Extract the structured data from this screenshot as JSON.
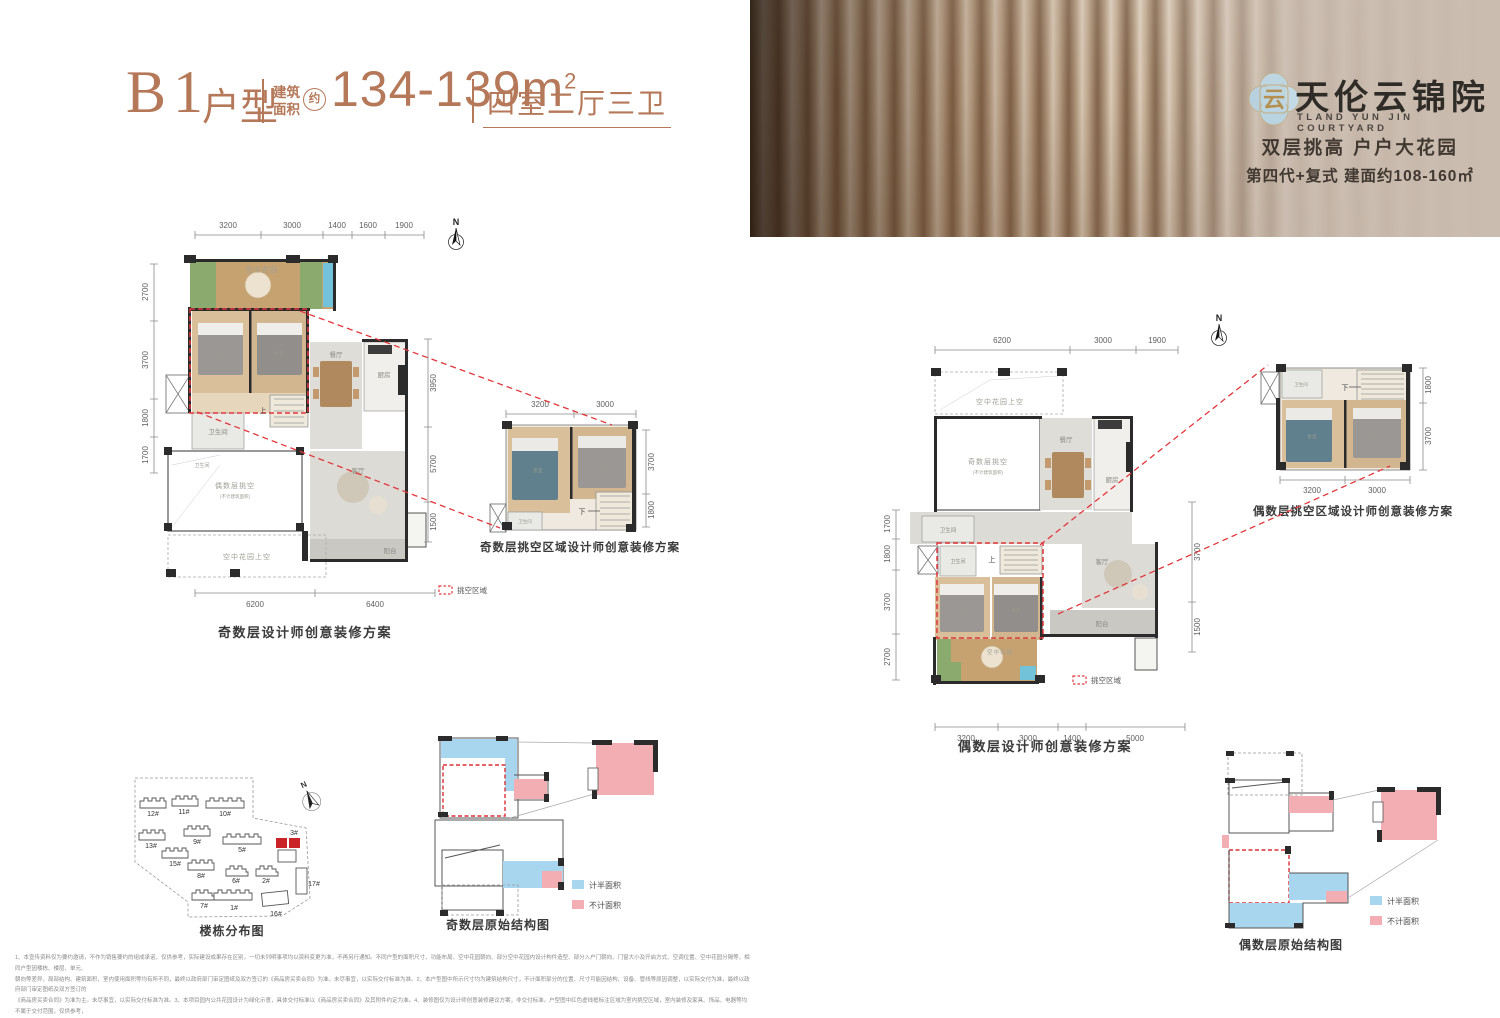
{
  "title": {
    "code": "B1",
    "type_label": "户型",
    "area_label_1": "建筑",
    "area_label_2": "面积",
    "approx": "约",
    "area_value": "134-139m",
    "area_exp": "2",
    "rooms": "四室二厅三卫"
  },
  "banner": {
    "logo_glyph": "云",
    "name": "天伦云锦院",
    "name_en": "TLAND YUN JIN COURTYARD",
    "tagline": "双层挑高 户户大花园",
    "subline": "第四代+复式  建面约108-160㎡"
  },
  "compass": {
    "label": "N"
  },
  "odd_main": {
    "caption": "奇数层设计师创意装修方案",
    "top_dims": [
      "3200",
      "3000",
      "1400",
      "1600",
      "1900"
    ],
    "left_dims": [
      "2700",
      "3700",
      "1800",
      "1700"
    ],
    "right_dims": [
      "3950",
      "5700",
      "1500"
    ],
    "bottom_dims": [
      "6200",
      "6400"
    ],
    "rooms": {
      "garden": "空中花园",
      "bed1": "卧室",
      "bed2": "卧室",
      "bath1": "卫生间",
      "bath2": "卫生间",
      "dining": "餐厅",
      "kitchen": "厨房",
      "living": "客厅",
      "balcony": "阳台",
      "void": "偶数层挑空",
      "void_sub": "(不计建筑面积)",
      "garden_above": "空中花园上空",
      "stair": "上"
    },
    "legend": "挑空区域"
  },
  "odd_loft": {
    "caption": "奇数层挑空区域设计师创意装修方案",
    "top_dims": [
      "3200",
      "3000"
    ],
    "right_dims": [
      "3700",
      "1800"
    ],
    "rooms": {
      "bed1": "卧室",
      "bed2": "卧室",
      "bath": "卫生间",
      "stair": "下"
    }
  },
  "even_main": {
    "caption": "偶数层设计师创意装修方案",
    "top_dims": [
      "6200",
      "3000",
      "1900"
    ],
    "left_dims": [
      "1700",
      "1800",
      "3700",
      "2700"
    ],
    "right_dims": [
      "3700",
      "1500"
    ],
    "bottom_dims": [
      "3200",
      "3000",
      "1400",
      "5000"
    ],
    "rooms": {
      "garden_above": "空中花园上空",
      "void": "奇数层挑空",
      "void_sub": "(不计建筑面积)",
      "dining": "餐厅",
      "kitchen": "厨房",
      "bath1": "卫生间",
      "bath2": "卫生间",
      "bed1": "卧室",
      "bed2": "卧室",
      "living": "客厅",
      "balcony": "阳台",
      "garden": "空中花园",
      "stair": "上"
    },
    "legend": "挑空区域"
  },
  "even_loft": {
    "caption": "偶数层挑空区域设计师创意装修方案",
    "bottom_dims": [
      "3200",
      "3000"
    ],
    "right_dims": [
      "1800",
      "3700"
    ],
    "rooms": {
      "bed1": "卧室",
      "bed2": "卧室",
      "bath": "卫生间",
      "stair": "下"
    }
  },
  "site_map": {
    "caption": "楼栋分布图",
    "buildings": [
      "12#",
      "11#",
      "10#",
      "13#",
      "9#",
      "5#",
      "3#",
      "15#",
      "8#",
      "6#",
      "2#",
      "7#",
      "1#",
      "16#",
      "17#"
    ],
    "highlighted": "3#"
  },
  "structure_odd": {
    "caption": "奇数层原始结构图"
  },
  "structure_even": {
    "caption": "偶数层原始结构图"
  },
  "structure_legend": {
    "half": {
      "label": "计半面积",
      "color": "#a9d6ef"
    },
    "excluded": {
      "label": "不计面积",
      "color": "#f2aeb2"
    }
  },
  "colors": {
    "accent": "#b5795a",
    "dashed_red": "#e2373c",
    "legend_blue": "#a9d6ef",
    "legend_pink": "#f2aeb2",
    "highlight_building": "#c92227"
  },
  "disclaimer": {
    "lines": [
      "1、本宣传资料仅为要约邀请，不作为销售要约的组成承诺，仅供参考，实际建设成果存在区别，一切未列明事项均以资料变更为准，不再另行通知。不同户型的面积尺寸、功能布局、空中花园朝向、部分空中花园内设计构件造型、部分入户门朝向、门窗大小及开启方式、空调位置、空中花园分隔等，相同户型因楼栋、楼层、单元、",
      "朝向等差异，局部结构、建筑面积、室内使用面积等均有所不同，最终以政府部门审定图纸及双方签订的《商品房买卖合同》为准。未尽事宜，以实际交付标准为准。2、本户型图中所示尺寸均为建筑结构尺寸，不计面积部分的位置、尺寸可能因结构、设备、管线等原因调整，以实际交付为准，最终以政府部门审定图纸及双方签订的",
      "《商品房买卖合同》为准为主。未尽事宜，以实际交付标准为准。3、本项目园内公共花园设计为绿化示意，具体交付标准以《商品房买卖合同》及其附件约定为准。4、装修图仅为设计师创意装修建议方案，非交付标准。户型图中红色虚线框标注区域为室内挑空区域，室内装修及家具、饰品、电器等均不属于交付范围，仅供参考，",
      "购房者装修尺寸需根据实际购房户型审定图纸及双方签订的《商品房买卖合同》为准。5、本宣传资料中户型图为设计师创意装修方案，红色虚线标注区域为室内挑空区域，室内装修设计及装修效果开发商建议并未承诺均可实现（包括但不限于空中花园），仅为业主户型改造建议参考，不作为交付标准。6、因城市规划道路调整、政府",
      "自不排除因适应规定、规划及出卖人分期规划未能控制等原因而发生变化。本宣传物料于2025年8月制作，本公司保留修改权力，敬请留意最新资料。7、本项目推广名为：天伦云锦院，地名办核准名为：云锦院，开发商：天伦地产，营销代理机构：湖南置远。"
    ]
  }
}
